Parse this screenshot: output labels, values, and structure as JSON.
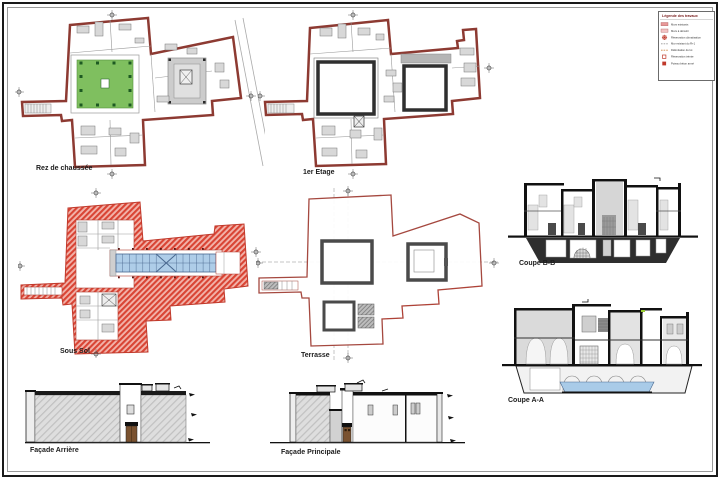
{
  "sheet": {
    "background": "#ffffff",
    "border_color": "#1a1a1a",
    "content": "Architectural drawing sheet with floor plans, sections and elevations of a riad building"
  },
  "drawings": {
    "plan_rdc": {
      "label": "Rez de chaussée",
      "type": "floor-plan"
    },
    "plan_etage1": {
      "label": "1er Etage",
      "type": "floor-plan"
    },
    "plan_soussol": {
      "label": "Sous Sol",
      "type": "floor-plan"
    },
    "plan_terrasses": {
      "label": "Terrasse",
      "type": "roof-plan"
    },
    "coupe_bb": {
      "label": "Coupe B-B",
      "type": "section"
    },
    "coupe_aa": {
      "label": "Coupe A-A",
      "type": "section"
    },
    "facade_arriere": {
      "label": "Façade Arrière",
      "type": "elevation"
    },
    "facade_principale": {
      "label": "Façade Principale",
      "type": "elevation"
    }
  },
  "legend": {
    "title": "Légende des travaux",
    "items": [
      {
        "symbol": "pink-fill-swatch",
        "label": "Murs existants"
      },
      {
        "symbol": "light-pink-swatch",
        "label": "Murs à démolir"
      },
      {
        "symbol": "red-rosette-icon",
        "label": "Réservation climatisation"
      },
      {
        "symbol": "gray-dashed-line",
        "label": "Mur existant du R+1"
      },
      {
        "symbol": "orange-dashed-line",
        "label": "Délimitation du lot"
      },
      {
        "symbol": "red-outline-square",
        "label": "Réservation trémie"
      },
      {
        "symbol": "red-filled-square",
        "label": "Poteau béton armé"
      }
    ]
  },
  "colors": {
    "wall_red": "#8d3a32",
    "hatch_red": "#d94434",
    "courtyard_green": "#7fbf5f",
    "column_green": "#1d5a22",
    "glazing_blue": "#aecde8",
    "pool_blue": "#a9cbe8",
    "section_black": "#111111",
    "gray_wash": "#d6d6d6",
    "door_brown": "#7a5230"
  }
}
